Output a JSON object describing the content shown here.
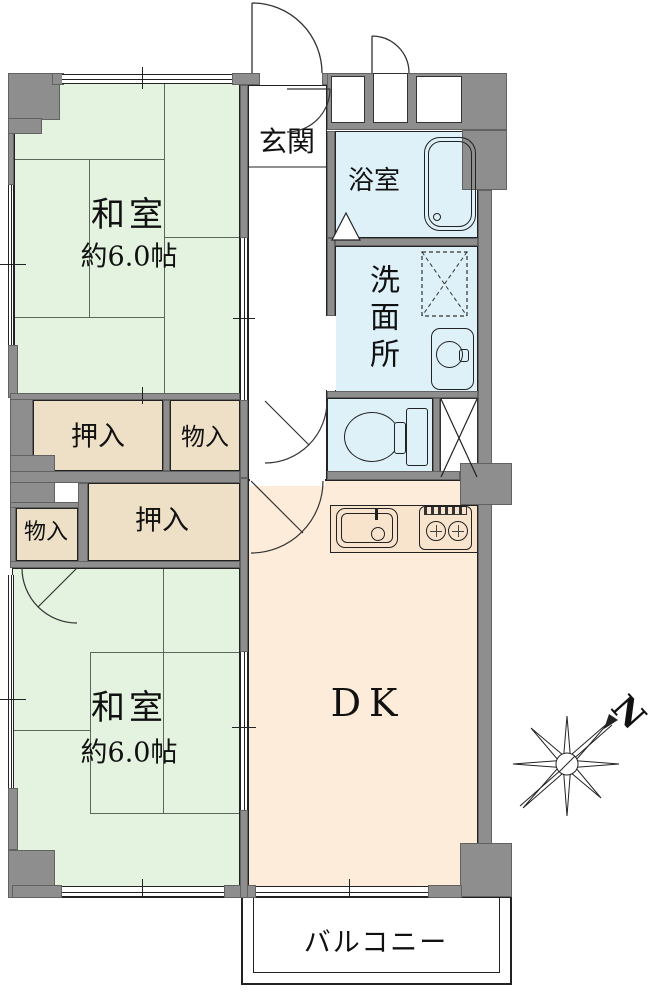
{
  "labels": {
    "room1_name": "和室",
    "room1_size": "約6.0帖",
    "room2_name": "和室",
    "room2_size": "約6.0帖",
    "genkan": "玄関",
    "bath": "浴室",
    "washroom": "洗面所",
    "closet1": "押入",
    "closet2": "押入",
    "storage1": "物入",
    "storage2": "物入",
    "dk": "DK",
    "balcony": "バルコニー",
    "north": "N"
  },
  "colors": {
    "wall": "#8e8e8e",
    "tatami": "#e4f3e0",
    "water": "#def1f8",
    "closet": "#eee0c6",
    "dk": "#fdecd9",
    "outline": "#222222"
  }
}
